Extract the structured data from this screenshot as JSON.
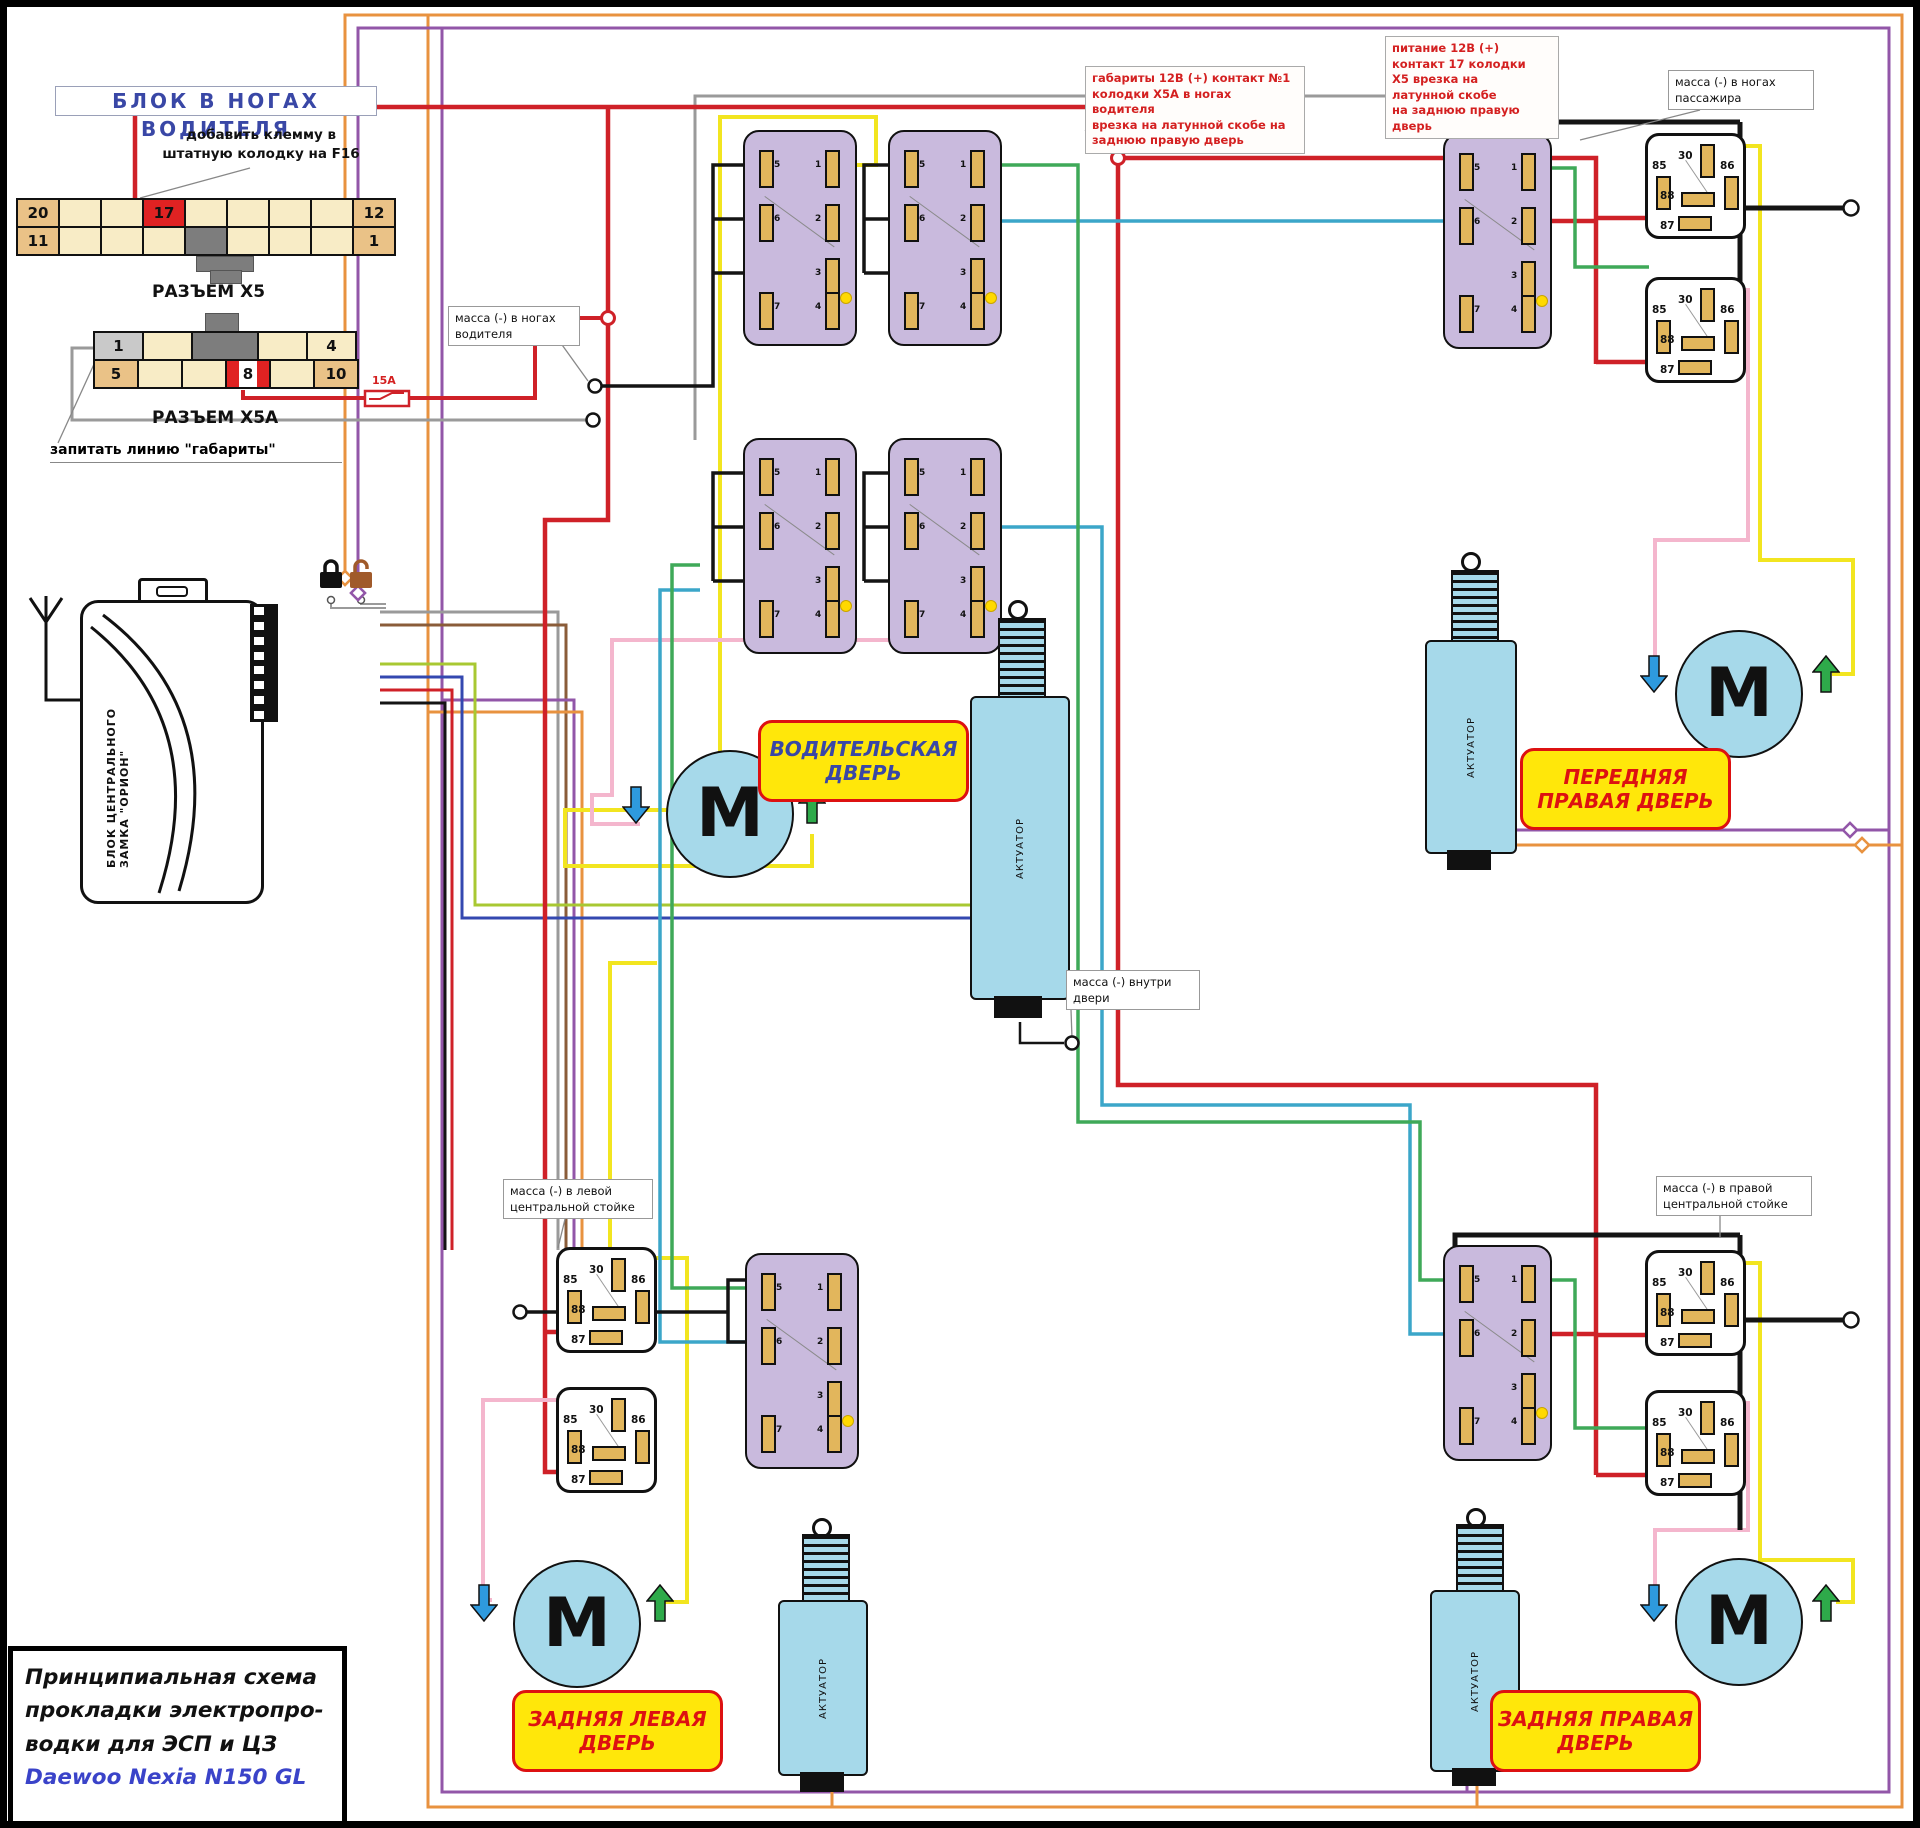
{
  "header": {
    "block_title": "БЛОК В НОГАХ ВОДИТЕЛЯ",
    "note_f16": "добавить клемму в\nштатную колодку на F16",
    "note_gabarity": "запитать линию \"габариты\"",
    "fuse_label": "15A"
  },
  "x5": {
    "label": "РАЗЪЕМ X5",
    "row1": [
      "20",
      "",
      "",
      "17",
      "",
      "",
      "",
      "",
      "12"
    ],
    "row2": [
      "11",
      "",
      "",
      "",
      "",
      "",
      "",
      "",
      "1"
    ]
  },
  "x5a": {
    "label": "РАЗЪЕМ X5A",
    "row1": [
      "1",
      "",
      "4"
    ],
    "row2": [
      "5",
      "",
      "",
      "8",
      "",
      "10"
    ]
  },
  "red_notes": {
    "gabarity": "габариты 12В (+) контакт №1\nколодки Х5А в ногах водителя\nврезка на латунной скобе на\nзаднюю правую дверь",
    "pitanie": "питание 12В (+)\nконтакт 17 колодки\nХ5 врезка на\nлатунной скобе\nна заднюю правую дверь"
  },
  "mass": {
    "driver": "масса (-) в ногах\nводителя",
    "passenger": "масса (-) в ногах\nпассажира",
    "inside_door": "масса (-) внутри\nдвери",
    "left_pillar": "масса (-) в левой\nцентральной стойке",
    "right_pillar": "масса (-) в правой\nцентральной стойке"
  },
  "doors": {
    "driver": "ВОДИТЕЛЬСКАЯ\nДВЕРЬ",
    "front_right": "ПЕРЕДНЯЯ\nПРАВАЯ ДВЕРЬ",
    "rear_left": "ЗАДНЯЯ ЛЕВАЯ\nДВЕРЬ",
    "rear_right": "ЗАДНЯЯ ПРАВАЯ\nДВЕРЬ"
  },
  "alarm": {
    "label": "БЛОК ЦЕНТРАЛЬНОГО\nЗАМКА \"ОРИОН\""
  },
  "motor": {
    "letter": "M"
  },
  "actuator": {
    "label": "АКТУАТОР"
  },
  "relay_pins": {
    "p30": "30",
    "p85": "85",
    "p86": "86",
    "p87": "87",
    "p88": "88"
  },
  "switch_pins": {
    "left": [
      "5",
      "6",
      "7"
    ],
    "right": [
      "1",
      "2",
      "3",
      "4"
    ]
  },
  "title_block": {
    "line1": "Принципиальная схема",
    "line2": "прокладки электропро-",
    "line3": "водки для ЭСП и ЦЗ",
    "line4": "Daewoo Nexia N150 GL"
  },
  "colors": {
    "wire_red": "#cf2128",
    "wire_yellow": "#f2e520",
    "wire_pink": "#f4b6cd",
    "wire_green": "#3fa958",
    "wire_teal": "#3ba6c9",
    "wire_blue": "#3448b0",
    "wire_gray": "#9a9a9a",
    "wire_black": "#141414",
    "wire_purple": "#9256a8",
    "wire_orange": "#e8923f",
    "wire_brown": "#8a5c39",
    "label_yellow": "#ffe70a",
    "accent_red": "#d42020",
    "accent_blue": "#3947a6"
  }
}
